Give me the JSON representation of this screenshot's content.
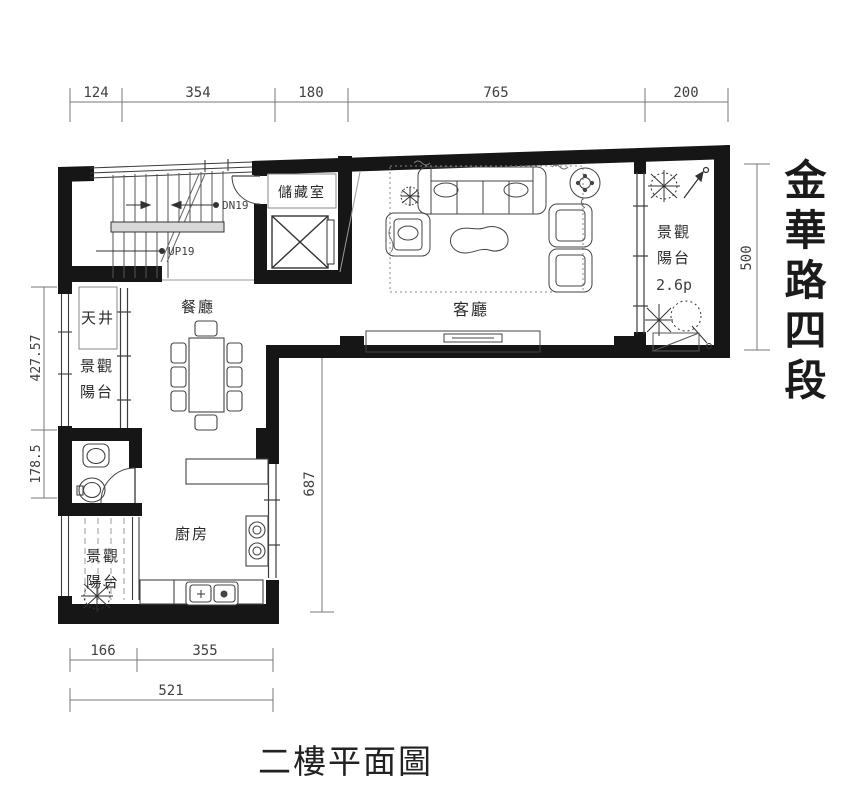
{
  "title": "二樓平面圖",
  "street_name": "金華路四段",
  "dimensions": {
    "top": [
      "124",
      "354",
      "180",
      "765",
      "200"
    ],
    "left_upper": "427.57",
    "left_lower": "178.5",
    "center_vertical": "687",
    "right_vertical": "500",
    "bottom_left": "166",
    "bottom_right": "355",
    "bottom_total": "521"
  },
  "rooms": {
    "living_room": "客廳",
    "dining_room": "餐廳",
    "kitchen": "廚房",
    "storage_room": "儲藏室",
    "light_well": "天井",
    "balcony_left_upper": {
      "line1": "景觀",
      "line2": "陽台"
    },
    "balcony_left_lower": {
      "line1": "景觀",
      "line2": "陽台"
    },
    "balcony_right": {
      "line1": "景觀",
      "line2": "陽台",
      "area": "2.6p"
    }
  },
  "stairs": {
    "up_label": "UP19",
    "down_label": "DN19"
  },
  "colors": {
    "wall": "#161616",
    "line": "#3c3c3c",
    "dim_line": "#777777",
    "rail_fill": "#d8d8d8"
  }
}
